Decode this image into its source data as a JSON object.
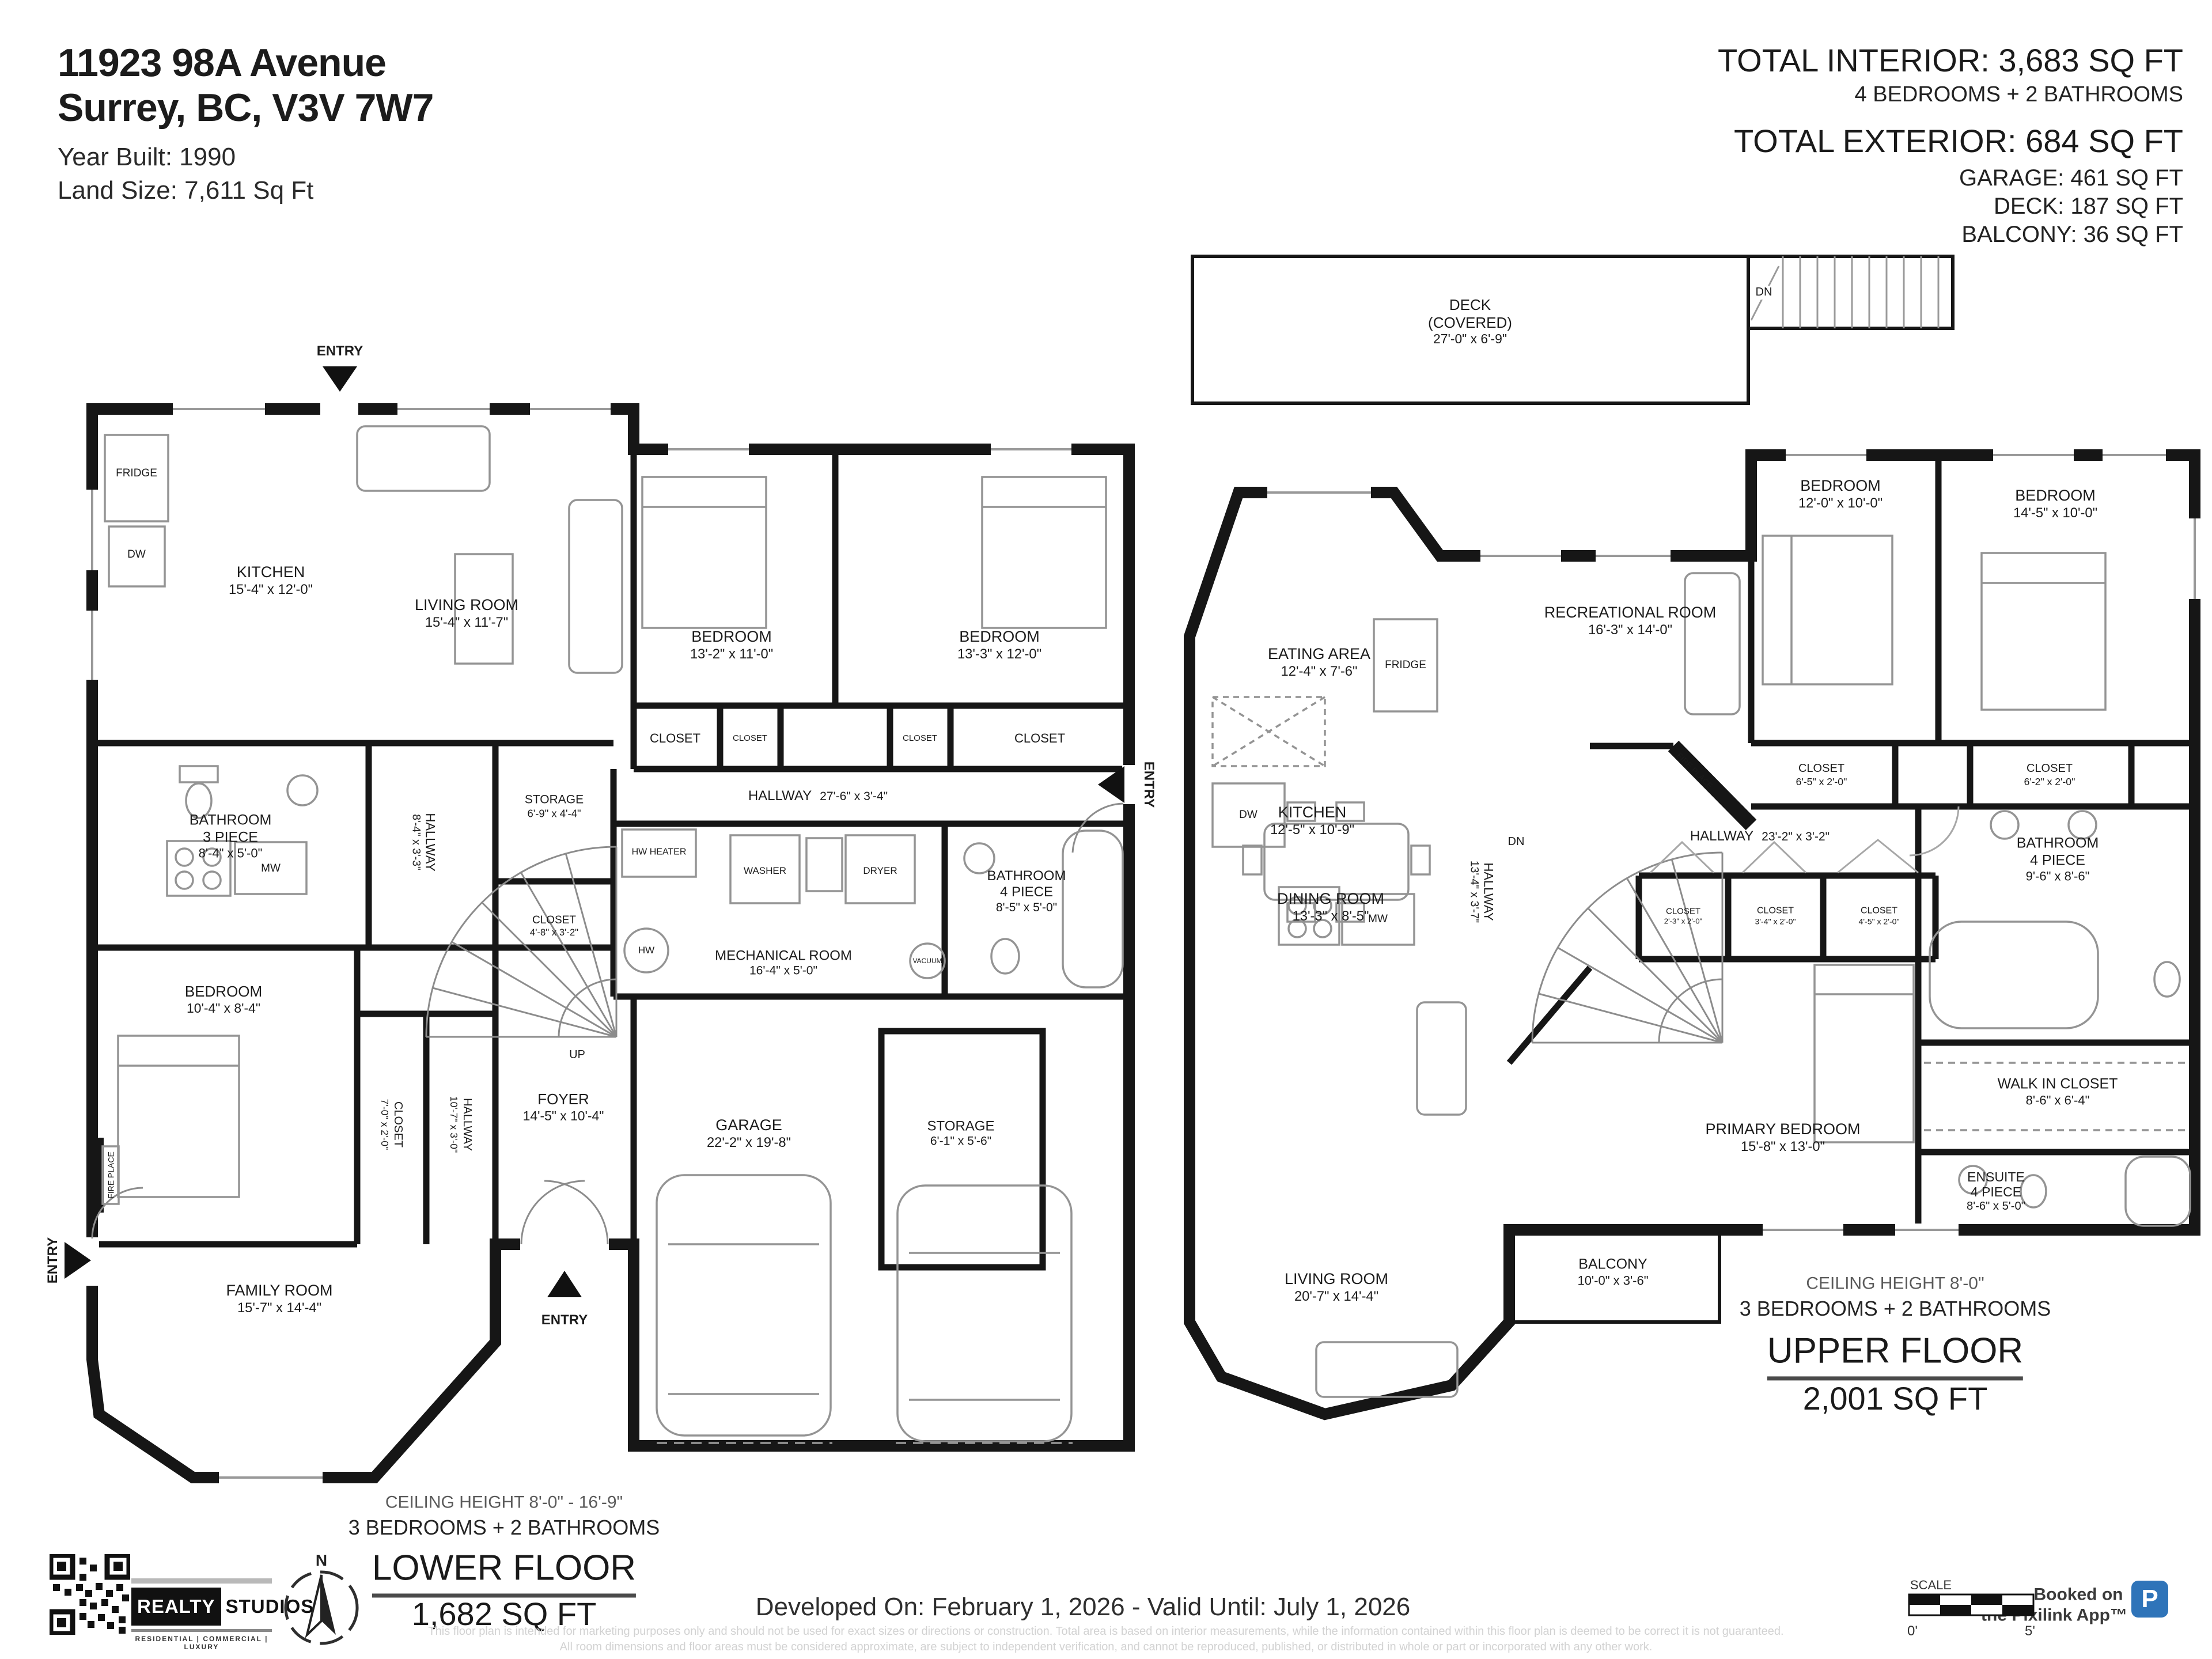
{
  "header": {
    "address_line1": "11923 98A Avenue",
    "address_line2": "Surrey, BC, V3V 7W7",
    "year_built": "Year Built: 1990",
    "land_size": "Land Size: 7,611 Sq Ft"
  },
  "totals": {
    "interior": "TOTAL INTERIOR: 3,683 SQ FT",
    "interior_sub": "4 BEDROOMS + 2 BATHROOMS",
    "exterior": "TOTAL EXTERIOR: 684 SQ FT",
    "garage": "GARAGE: 461 SQ FT",
    "deck": "DECK: 187 SQ FT",
    "balcony": "BALCONY: 36 SQ FT"
  },
  "lower": {
    "entry": "ENTRY",
    "up": "UP",
    "fireplace": "FIRE PLACE",
    "appliances": {
      "fridge": "FRIDGE",
      "dw": "DW",
      "mw": "MW",
      "hw_heater": "HW HEATER",
      "hw": "HW",
      "washer": "WASHER",
      "dryer": "DRYER",
      "vacuum": "VACUUM"
    },
    "rooms": {
      "kitchen": {
        "name": "KITCHEN",
        "dims": "15'-4\" x 12'-0\""
      },
      "living": {
        "name": "LIVING ROOM",
        "dims": "15'-4\" x 11'-7\""
      },
      "bedroom1": {
        "name": "BEDROOM",
        "dims": "13'-2\" x 11'-0\""
      },
      "bedroom2": {
        "name": "BEDROOM",
        "dims": "13'-3\" x 12'-0\""
      },
      "closet1": {
        "name": "CLOSET"
      },
      "closet2": {
        "name": "CLOSET"
      },
      "closet3": {
        "name": "CLOSET"
      },
      "closet4": {
        "name": "CLOSET"
      },
      "hallway_main": {
        "name": "HALLWAY",
        "dims": "27'-6\" x 3'-4\""
      },
      "storage1": {
        "name": "STORAGE",
        "dims": "6'-9\" x 4'-4\""
      },
      "bathroom3": {
        "name": "BATHROOM",
        "type": "3 PIECE",
        "dims": "8'-4\" x 5'-0\""
      },
      "hallway_v1": {
        "name": "HALLWAY",
        "dims": "8'-4\" x 3'-3\""
      },
      "closet5": {
        "name": "CLOSET",
        "dims": "4'-8\" x 3'-2\""
      },
      "bedroom3": {
        "name": "BEDROOM",
        "dims": "10'-4\" x 8'-4\""
      },
      "closet6": {
        "name": "CLOSET",
        "dims": "7'-0\" x 2'-0\""
      },
      "hallway_v2": {
        "name": "HALLWAY",
        "dims": "10'-7\" x 3'-0\""
      },
      "mechanical": {
        "name": "MECHANICAL ROOM",
        "dims": "16'-4\" x 5'-0\""
      },
      "bathroom4": {
        "name": "BATHROOM",
        "type": "4 PIECE",
        "dims": "8'-5\" x 5'-0\""
      },
      "garage": {
        "name": "GARAGE",
        "dims": "22'-2\" x 19'-8\""
      },
      "storage2": {
        "name": "STORAGE",
        "dims": "6'-1\" x 5'-6\""
      },
      "foyer": {
        "name": "FOYER",
        "dims": "14'-5\" x 10'-4\""
      },
      "family": {
        "name": "FAMILY ROOM",
        "dims": "15'-7\" x 14'-4\""
      }
    },
    "footer": {
      "ceiling": "CEILING HEIGHT 8'-0\" - 16'-9\"",
      "config": "3 BEDROOMS + 2 BATHROOMS",
      "title": "LOWER FLOOR",
      "area": "1,682 SQ FT"
    }
  },
  "upper": {
    "dn": "DN",
    "fireplace": "FIRE PLACE",
    "appliances": {
      "dw": "DW",
      "fridge": "FRIDGE",
      "mw": "MW"
    },
    "rooms": {
      "deck": {
        "name": "DECK",
        "type": "(COVERED)",
        "dims": "27'-0\" x 6'-9\""
      },
      "eating": {
        "name": "EATING AREA",
        "dims": "12'-4\" x 7'-6\""
      },
      "rec": {
        "name": "RECREATIONAL ROOM",
        "dims": "16'-3\" x 14'-0\""
      },
      "kitchen": {
        "name": "KITCHEN",
        "dims": "12'-5\" x 10'-9\""
      },
      "bedroom1": {
        "name": "BEDROOM",
        "dims": "12'-0\" x 10'-0\""
      },
      "bedroom2": {
        "name": "BEDROOM",
        "dims": "14'-5\" x 10'-0\""
      },
      "closet1": {
        "name": "CLOSET",
        "dims": "6'-5\" x 2'-0\""
      },
      "closet2": {
        "name": "CLOSET",
        "dims": "6'-2\" x 2'-0\""
      },
      "hallway": {
        "name": "HALLWAY",
        "dims": "23'-2\" x 3'-2\""
      },
      "hallway_v": {
        "name": "HALLWAY",
        "dims": "13'-4\" x 3'-7\""
      },
      "closet3": {
        "name": "CLOSET",
        "dims": "2'-3\" x 2'-0\""
      },
      "closet4": {
        "name": "CLOSET",
        "dims": "3'-4\" x 2'-0\""
      },
      "closet5": {
        "name": "CLOSET",
        "dims": "4'-5\" x 2'-0\""
      },
      "bathroom": {
        "name": "BATHROOM",
        "type": "4 PIECE",
        "dims": "9'-6\" x 8'-6\""
      },
      "wic": {
        "name": "WALK IN CLOSET",
        "dims": "8'-6\" x 6'-4\""
      },
      "primary": {
        "name": "PRIMARY BEDROOM",
        "dims": "15'-8\" x 13'-0\""
      },
      "ensuite": {
        "name": "ENSUITE",
        "type": "4 PIECE",
        "dims": "8'-6\" x 5'-0\""
      },
      "dining": {
        "name": "DINING ROOM",
        "dims": "13'-3\" x 8'-5\""
      },
      "living": {
        "name": "LIVING ROOM",
        "dims": "20'-7\" x 14'-4\""
      },
      "balcony": {
        "name": "BALCONY",
        "dims": "10'-0\" x 3'-6\""
      }
    },
    "footer": {
      "ceiling": "CEILING HEIGHT 8'-0\"",
      "config": "3 BEDROOMS + 2 BATHROOMS",
      "title": "UPPER FLOOR",
      "area": "2,001 SQ FT"
    }
  },
  "footer": {
    "developed": "Developed On: February 1, 2026 - Valid Until: July 1, 2026",
    "disclaimer1": "This floor plan is intended for marketing purposes only and should not be used for exact sizes or directions or construction. Total area is based on interior measurements, while the information contained within this floor plan is deemed to be correct it is not guaranteed.",
    "disclaimer2": "All room dimensions and floor areas must be considered approximate, are subject to independent verification, and cannot be reproduced, published, or distributed in whole or part or incorporated with any other work.",
    "logo": {
      "realty": "REALTY",
      "studios": "STUDIOS",
      "tagline": "RESIDENTIAL | COMMERCIAL | LUXURY"
    },
    "compass": {
      "n": "N"
    },
    "scale": {
      "label": "SCALE",
      "start": "0'",
      "end": "5'"
    },
    "pixilink": {
      "line1": "Booked on",
      "line2": "the Pixilink App™",
      "mark": "P"
    }
  }
}
